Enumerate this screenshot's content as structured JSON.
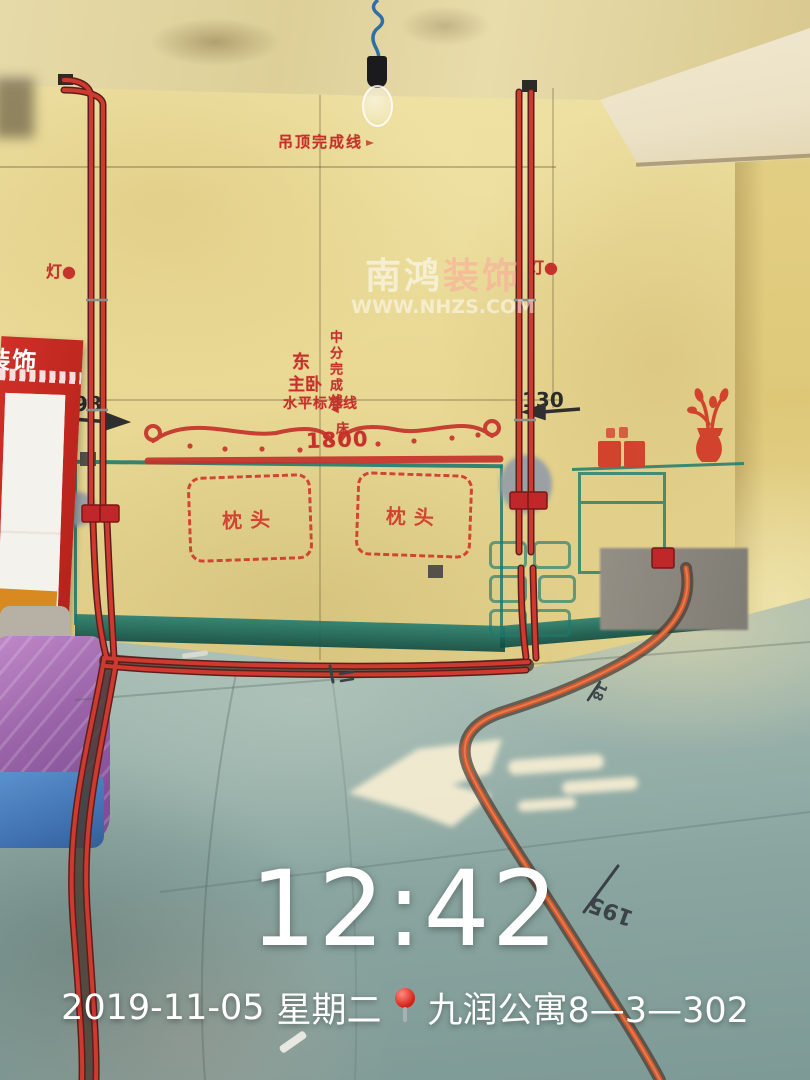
{
  "watermark": {
    "brand_a": "南鸿",
    "brand_b": "装饰",
    "url": "WWW.NHZS.COM"
  },
  "timestamp": {
    "time": "12:42",
    "date": "2019-11-05",
    "weekday": "星期二",
    "location": "九润公寓8—3—302"
  },
  "wall": {
    "ceiling_line": "吊顶完成线",
    "lamp_left": "灯●",
    "lamp_right": "灯●",
    "center_line": "中分完成线",
    "center_arrow": "◀",
    "direction": "东",
    "room": "主卧",
    "level_line": "水平标准线",
    "dim_left": "98",
    "dim_right": "130",
    "bed_label": "床",
    "bed_size": "1800",
    "pillow": "枕头"
  },
  "floor": {
    "dim_long": "195",
    "dim_short": "18"
  },
  "board": {
    "brand": "装饰"
  },
  "icons": {
    "location_pin": "red-map-pin",
    "hanging_bulb": "bare-light-bulb"
  },
  "colors": {
    "wall_yellow": "#e9d995",
    "floor_teal": "#93afa9",
    "stencil_red": "#c5322b",
    "layout_teal": "#1f7a6d",
    "conduit_red": "#c0272a",
    "conduit_orange": "#d2572b",
    "board_red": "#c32822",
    "overlay_white": "#ffffff"
  }
}
